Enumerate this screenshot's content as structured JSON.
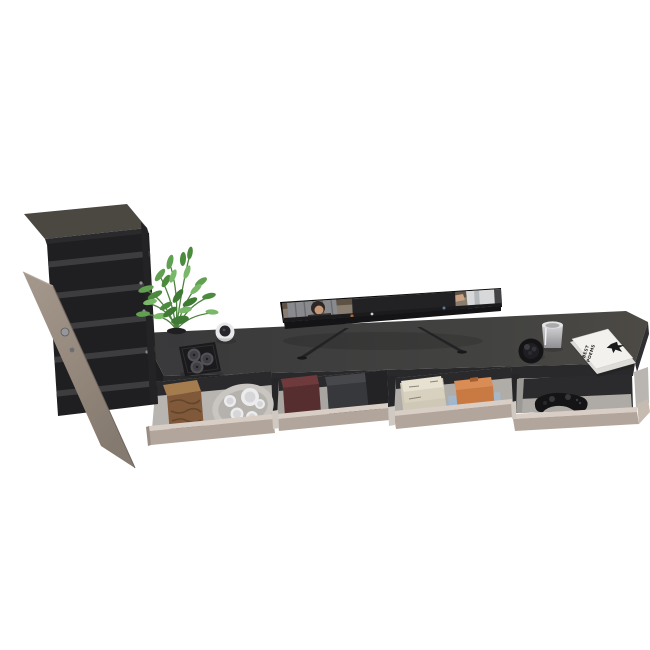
{
  "title": "Wall-mounted TV stand with open drawers and tall cabinet – furniture product render",
  "colors": {
    "background": "#ffffff",
    "cabinet_top": "#4b4741",
    "cabinet_interior": "#1f1f21",
    "cabinet_shelf": "#3d3d3f",
    "door": "#9b8e82",
    "console_top": "#404042",
    "console_front": "#29292b",
    "drawer_front": "#b2a59b",
    "drawer_rim": "#d8cec5",
    "drawer_interior": "#b8b4b0",
    "drawer_back": "#2a2a2c",
    "wood_box": "#80583a",
    "wood_grain": "#5e4227",
    "maroon_box": "#572e30",
    "gray_box": "#36383c",
    "paper": "#cfc8b6",
    "orange_box": "#c97a43",
    "led_glow": "#8ab6e8",
    "gamepad": "#141416",
    "ceramic": "#ececee",
    "candle_tray": "#1a1a1c",
    "candle": "#515156",
    "bowl": "#141416",
    "glass": "#c9c9cb",
    "magazine": "#f3f1ed",
    "plant_green": "#5d9a4d",
    "pot": "#39393b",
    "tv_bezel": "#141416",
    "tv_leg": "#232325"
  },
  "furniture": {
    "cabinet": {
      "label": "tall storage cabinet with open door",
      "shelf_count": 5
    },
    "console": {
      "label": "wall-mounted TV stand",
      "drawers": [
        {
          "label": "drawer 1 (open)",
          "contents": [
            "wooden box",
            "oval tray with white tea set"
          ]
        },
        {
          "label": "drawer 2 (open)",
          "contents": [
            "maroon storage box",
            "dark gray storage box"
          ]
        },
        {
          "label": "drawer 3 (open)",
          "contents": [
            "stack of papers",
            "orange box"
          ],
          "led": "blue LED glow"
        },
        {
          "label": "drawer 4 (open)",
          "contents": [
            "black game controller"
          ]
        }
      ]
    }
  },
  "items": {
    "tv": {
      "label": "flat-screen TV showing two people at desks"
    },
    "plant": {
      "label": "potted fern"
    },
    "candle_tray": {
      "label": "black square tray with three candles"
    },
    "white_candle": {
      "label": "white round candle holder"
    },
    "bowl": {
      "label": "black decorative bowl"
    },
    "glass_candle": {
      "label": "glass tealight holder"
    },
    "magazine": {
      "label": "stacked magazines",
      "title_line1": "BEST",
      "title_line2": "POEMS"
    },
    "gamepad": {
      "label": "game controller"
    }
  }
}
